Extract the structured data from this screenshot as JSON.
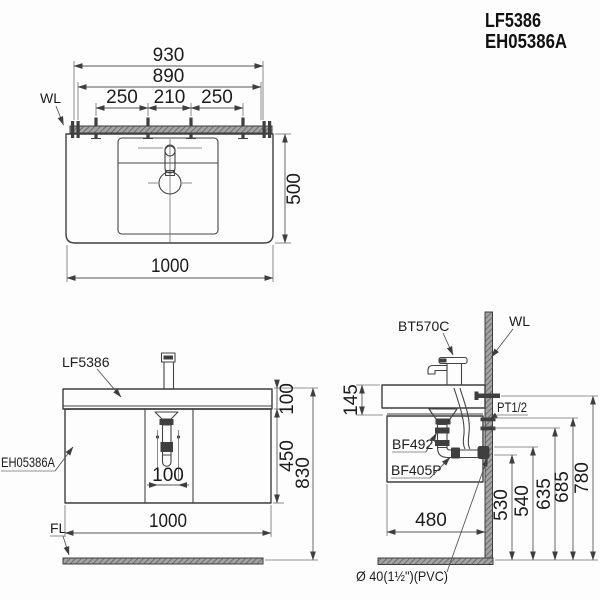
{
  "page": {
    "background_color": "#fdfdfd",
    "line_color": "#3e3e3e",
    "hatch_color": "#9a9a9a"
  },
  "header": {
    "model_primary": "LF5386",
    "model_secondary": "EH05386A"
  },
  "top_view": {
    "wall_line_label": "WL",
    "dim_rail_width": "930",
    "dim_mount_span": "890",
    "dim_left_spacing": "250",
    "dim_center_spacing": "210",
    "dim_right_spacing": "250",
    "dim_depth": "500",
    "dim_width": "1000"
  },
  "front_view": {
    "basin_label": "LF5386",
    "cabinet_label": "EH05386A",
    "floor_line_label": "FL",
    "dim_basin_height": "100",
    "dim_cabinet_height": "450",
    "dim_total_height": "830",
    "dim_drain_width": "100",
    "dim_width": "1000"
  },
  "side_view": {
    "faucet_label": "BT570C",
    "wall_line_label": "WL",
    "inlet_label": "PT1/2",
    "drain_fitting_label": "BF492",
    "trap_fitting_label": "BF405P",
    "pipe_spec_label": "Ø 40(1½\")(PVC)",
    "dim_basin_section": "145",
    "dim_depth": "480",
    "dim_outlet_height": "530",
    "dim_pipe_height": "540",
    "dim_inlet_lower": "635",
    "dim_inlet_upper": "685",
    "dim_supply_height": "780"
  }
}
